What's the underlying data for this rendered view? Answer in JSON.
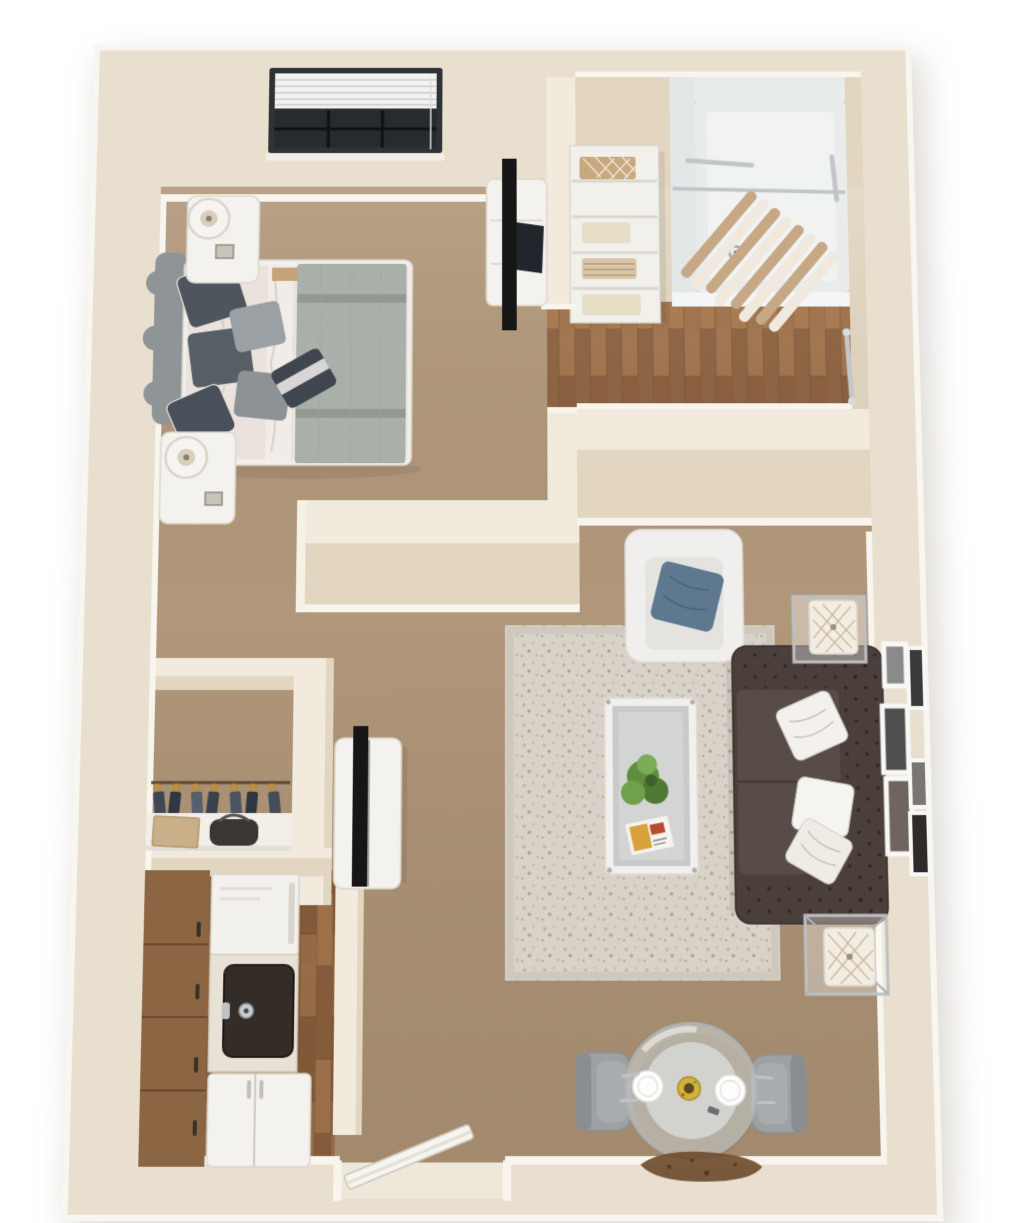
{
  "scene": {
    "type": "3d-floor-plan",
    "description": "Top-down 3D dollhouse render of a one-bedroom, one-bath apartment",
    "rendered_text": "none"
  },
  "palette": {
    "background": "#FFFFFF",
    "wall": "#E9DFCE",
    "wall_cap": "#F2EBDD",
    "wall_face": "#E2D6C1",
    "baseboard": "#F8F5EE",
    "carpet": "#B1977A",
    "carpet_dark": "#A28869",
    "wood_floor": "#98693F",
    "rug": "#D8D2C8",
    "rug_speckle": "#B4A997",
    "sofa": "#4B3F3C",
    "sofa_seat": "#584C48",
    "armchair": "#F1EFED",
    "accent_pillow": "#5E7890",
    "bed_duvet": "#EBE2DD",
    "bed_throw": "#A9AFA9",
    "headboard": "#8F9496",
    "white_furniture": "#F4F2EE",
    "tv": "#161616",
    "cabinet": "#8C6543",
    "sink": "#332C27",
    "chrome": "#BCC0C2",
    "shower": "#EAECEC",
    "curtain_stripe": "#C7A885",
    "glass": "#C8CBCA",
    "chair_gray": "#9DA1A3",
    "doormat": "#6E4C2E",
    "plate": "#FDFDFC",
    "bowl_yellow": "#D2B23E",
    "plant": "#5F8F3E",
    "towel_tan": "#C9A87E",
    "towel_cream": "#E7DEC8",
    "hanger_gold": "#C08A2E"
  },
  "rooms": [
    {
      "id": "bedroom",
      "label": "bedroom",
      "floor": "carpet",
      "contents": [
        "queen bed",
        "upholstered headboard",
        "gray throw blanket",
        "pillow stack",
        "two nightstands",
        "two round table lamps",
        "dresser",
        "flat-screen tv",
        "window with blinds"
      ]
    },
    {
      "id": "bathroom",
      "label": "bathroom",
      "floor": "hardwood",
      "contents": [
        "walk-in shower",
        "striped shower curtain",
        "curtain rod",
        "grab bars",
        "floor drain",
        "linen shelf with towels"
      ]
    },
    {
      "id": "closet",
      "label": "closet",
      "floor": "carpet",
      "contents": [
        "hanging rod",
        "seven hangers with garments",
        "shelf",
        "storage box",
        "bag"
      ]
    },
    {
      "id": "living-room",
      "label": "living room",
      "floor": "carpet with area rug",
      "contents": [
        "tufted chesterfield sofa",
        "three white pillows",
        "white armchair",
        "blue accent pillow",
        "glass coffee table",
        "potted plant",
        "magazine",
        "two chrome end tables with cube lamps",
        "media console",
        "flat-screen tv",
        "six framed pictures"
      ]
    },
    {
      "id": "dining-nook",
      "label": "dining nook",
      "floor": "carpet",
      "contents": [
        "round glass table",
        "two gray chairs",
        "two plates",
        "centerpiece bowl",
        "cutlery",
        "doormat"
      ]
    },
    {
      "id": "kitchen",
      "label": "kitchen",
      "floor": "hardwood",
      "contents": [
        "cabinet run",
        "stove",
        "counter with sink",
        "faucet",
        "refrigerator"
      ]
    },
    {
      "id": "entry",
      "label": "entry",
      "contents": [
        "open entry door",
        "threshold"
      ]
    }
  ],
  "counts": {
    "hangers": 7,
    "gallery_frames": 6,
    "towel_stacks": 4,
    "dining_plates": 2,
    "sofa_pillows": 3,
    "bed_pillows": 6,
    "nightstands": 2,
    "end_tables": 2
  }
}
